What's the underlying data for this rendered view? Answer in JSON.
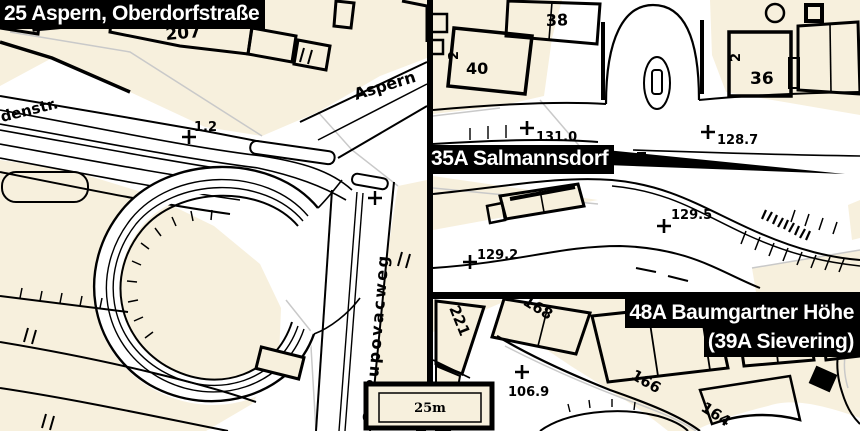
{
  "panel_labels": {
    "aspern": "25 Aspern, Oberdorfstraße",
    "salmannsdorf": "35A Salmannsdorf",
    "baumgartner_line1": "48A Baumgartner Höhe",
    "baumgartner_line2": "(39A Sievering)"
  },
  "street_names": {
    "denstr": "denstr.",
    "aspern": "Aspern",
    "pupovacweg": "O. Pupovacweg"
  },
  "building_numbers": {
    "n205": "205",
    "n207": "207",
    "n38": "38",
    "n40": "40",
    "n40_annex": "2",
    "n36": "36",
    "n36_annex": "2",
    "n221": "221",
    "n168": "168",
    "n166": "166",
    "n164": "164"
  },
  "elevation_points": {
    "p1_2": "1.2",
    "p131_0": "131.0",
    "p128_7": "128.7",
    "p129_5": "129.5",
    "p129_2": "129.2",
    "p106_9": "106.9"
  },
  "scale_bar": {
    "label": "25m"
  },
  "colors": {
    "parcel_fill": "#f7f0dd",
    "road_fill": "#ffffff",
    "line_ink": "#000000",
    "parcel_line": "#c9c9c9",
    "label_bg": "#000000",
    "label_fg": "#ffffff"
  }
}
